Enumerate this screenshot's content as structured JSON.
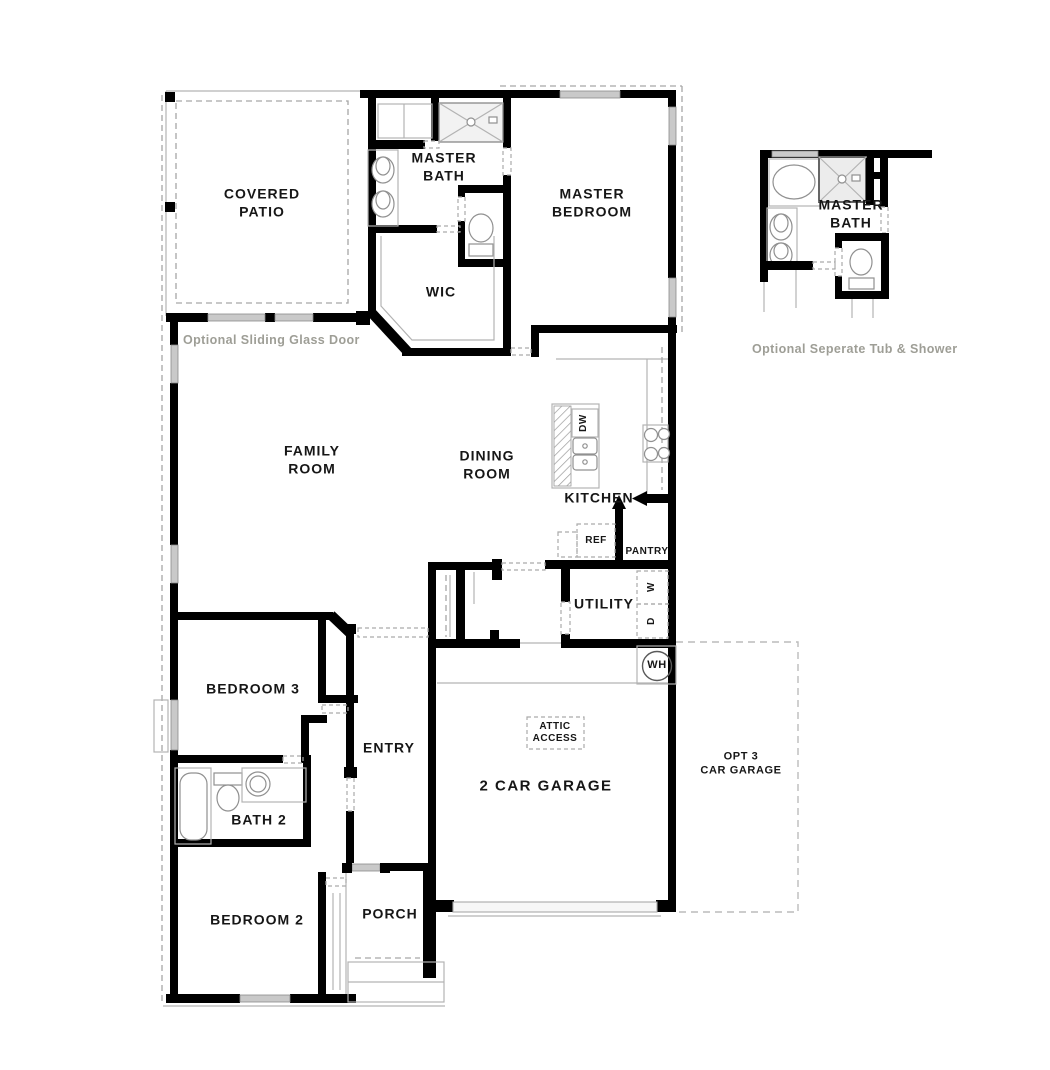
{
  "plan": {
    "rooms": {
      "covered_patio": "COVERED\nPATIO",
      "master_bath": "MASTER\nBATH",
      "master_bedroom": "MASTER\nBEDROOM",
      "wic": "WIC",
      "family_room": "FAMILY\nROOM",
      "dining_room": "DINING\nROOM",
      "kitchen": "KITCHEN",
      "utility": "UTILITY",
      "bedroom3": "BEDROOM 3",
      "entry": "ENTRY",
      "bath2": "BATH 2",
      "bedroom2": "BEDROOM 2",
      "porch": "PORCH",
      "garage": "2 CAR GARAGE",
      "opt_garage": "OPT 3\nCAR GARAGE",
      "attic_access": "ATTIC\nACCESS"
    },
    "appliances": {
      "dishwasher": "DW",
      "refrigerator": "REF",
      "pantry": "PANTRY",
      "washer": "W",
      "dryer": "D",
      "water_heater": "WH"
    },
    "notes": {
      "sliding_door": "Optional Sliding Glass Door",
      "tub_shower": "Optional Seperate Tub & Shower"
    },
    "detail": {
      "master_bath": "MASTER\nBATH"
    },
    "colors": {
      "wall": "#000000",
      "window_fill": "#c9c9c9",
      "caption_text": "#9e9e96",
      "dashed_line": "#a6a6a6"
    }
  }
}
